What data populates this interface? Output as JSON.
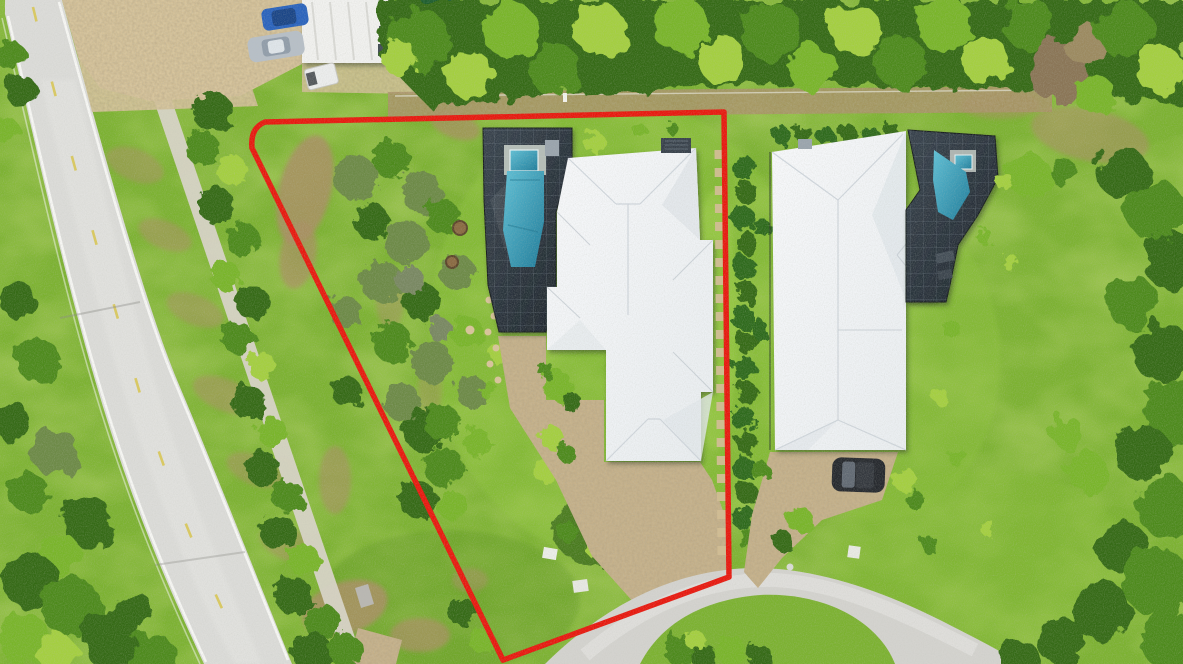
{
  "scene": {
    "type": "aerial-drone-photo",
    "description": "Overhead aerial photo of a vacant treed residential lot outlined with a red boundary line, beside a two-lane road with yellow center dashes, a white-roofed house with screened blue pool inside the lot line, a neighboring white-roofed house with screened pool to the east, pebble driveways leading to a light gray cul-de-sac, dense tropical tree canopy along the top, and a parking area with cars and a white canopy at the top left.",
    "boundary": {
      "label": "red property boundary line",
      "shape": "irregular triangle-like polygon",
      "corners_px": [
        [
          265,
          122
        ],
        [
          724,
          112
        ],
        [
          728,
          577
        ],
        [
          503,
          660
        ],
        [
          252,
          148
        ]
      ]
    }
  },
  "objects": {
    "road": "two-lane asphalt road with white edge lines and yellow dashed center line",
    "sidewalk": "concrete sidewalk path east of road",
    "parking_area": "sand parking area with vehicles",
    "canopy_carport": "white canopy structure",
    "pond": "dark green pond",
    "car_blue": "blue car",
    "car_silver": "silver car",
    "truck_white": "white utility truck",
    "bin_blue": "blue bin",
    "north_canopy": "dense tropical tree canopy",
    "dirt_track": "sandy track along north lot line",
    "lot_scrub": "native scrub trees and dirt patches inside lot",
    "main_house": "white hip-roof house",
    "main_pool_enclosure": "dark screened pool enclosure",
    "main_pool": "blue swimming pool with spa",
    "stone_path": "stepping stone path and fire pit",
    "main_driveway": "tan pebble courtyard and driveway",
    "cul_de_sac": "light gray cul-de-sac road",
    "grass_island": "grass island with shrubs inside cul-de-sac",
    "right_house": "neighboring white hip-roof house",
    "right_pool_enclosure": "dark screened pool enclosure of neighbor",
    "right_pool": "neighbor blue pool with spa",
    "hedge_row": "hedge row along shared boundary",
    "stepping_stones": "paver stepping stones along boundary",
    "right_driveway": "neighbor pebble driveway",
    "car_dark": "dark parked car",
    "right_trees": "tall trees along right edge",
    "boundary_line": "red lot boundary outline"
  },
  "palette": {
    "boundary_red": "#e8190f",
    "roof_white": "#f3f4f6",
    "roof_shade": "#e2e7eb",
    "pool_blue": "#2f92ad",
    "pool_light": "#5fc0d6",
    "cage_dark": "#2b343d",
    "road_gray": "#dcdcd9",
    "road_line_white": "#f8f8f5",
    "lane_yellow": "#d9c751",
    "sidewalk_gray": "#d8d4c7",
    "culdesac_gray": "#d4d3cf",
    "driveway_tan": "#c8b38c",
    "sand": "#d9c69d",
    "grass_base": "#7cb231",
    "grass_light": "#92c83e",
    "grass_dark": "#5d9423",
    "grass_yellow": "#aac24d",
    "tree_dark": "#356a17",
    "tree_mid": "#4d8a1d",
    "tree_bright": "#79b52c",
    "palm_bright": "#a4cf3f",
    "scrub_olive": "#6d8a46",
    "dirt_brown": "#a98f63",
    "hedge_green": "#2f6b1f",
    "water_pond": "#1e5e2e",
    "car_blue": "#2a63bd",
    "car_silver": "#b7bfc7",
    "car_dark": "#26292e",
    "truck_white": "#eceded",
    "bin_blue": "#1c4f9e",
    "canopy_white": "#f1f1ef"
  }
}
